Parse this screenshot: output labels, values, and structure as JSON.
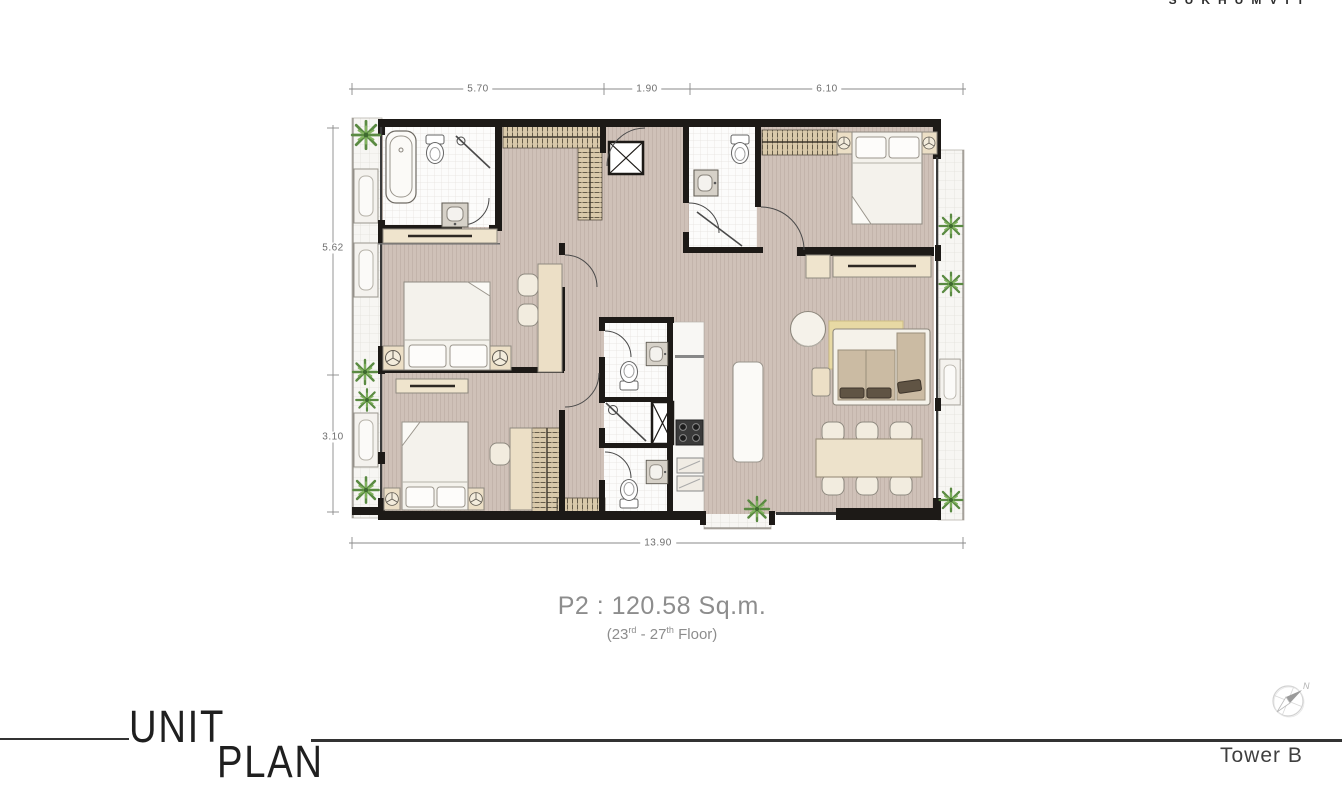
{
  "brand": {
    "name": "SUKHUMVIT"
  },
  "plan": {
    "title": "P2 : 120.58 Sq.m.",
    "floor": {
      "p1": "(23",
      "sup1": "rd",
      "p2": " - 27",
      "sup2": "th",
      "p3": " Floor)"
    },
    "dimensions": {
      "top": [
        "5.70",
        "1.90",
        "6.10"
      ],
      "left": [
        "5.62",
        "3.10"
      ],
      "bottom": [
        "13.90"
      ]
    }
  },
  "footer": {
    "word1": "UNIT",
    "word2": "PLAN",
    "tower": "Tower B"
  },
  "compass": {
    "north": "N"
  },
  "colors": {
    "wall": "#1d1a17",
    "floor": "#cfc1b8",
    "closet": "#d9c9aa",
    "furniture_beige": "#ecdfc6",
    "rug": "#e7d9a4",
    "plant_green": "#5a8a42",
    "dim_gray": "#8a8a8a"
  }
}
